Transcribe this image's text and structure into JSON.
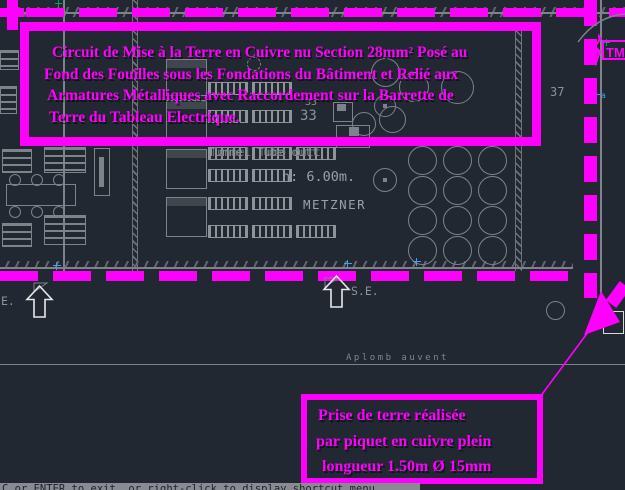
{
  "window": {
    "statusbar_message": "C or ENTER to exit, or right-click to display shortcut menu."
  },
  "notes": {
    "grounding_lines": [
      "Circuit de Mise à la Terre en Cuivre nu Section 28mm² Posé au",
      "Fond des Fouilles sous les Fondations du Bâtiment et Relié aux",
      "Armatures Métalliques avec Raccordement sur la Barrette de",
      "Terre du Tableau Electrique."
    ],
    "earth_rod_lines": [
      "Prise de terre réalisée",
      "par piquet en cuivre plein",
      "longueur 1.50m Ø 15mm"
    ],
    "tm_label": "TM"
  },
  "plan": {
    "labels": {
      "room_small": "33",
      "room_large": "33",
      "room_right": "37",
      "height": "h: 6.00m.",
      "machine_brand": "METZNER",
      "tunnel_overlay": "Tunnel Tube cutting",
      "exit_se": "S.E.",
      "exit_se_clipped": "E.",
      "canopy": "Aplomb auvent",
      "node_marker": "a"
    }
  },
  "colors": {
    "magenta": "#ff00ff",
    "background": "#222831",
    "linework": "#7e8289",
    "label_gray": "#8d9298",
    "marker_blue": "#45a0e6",
    "marker_green": "#00a651"
  }
}
